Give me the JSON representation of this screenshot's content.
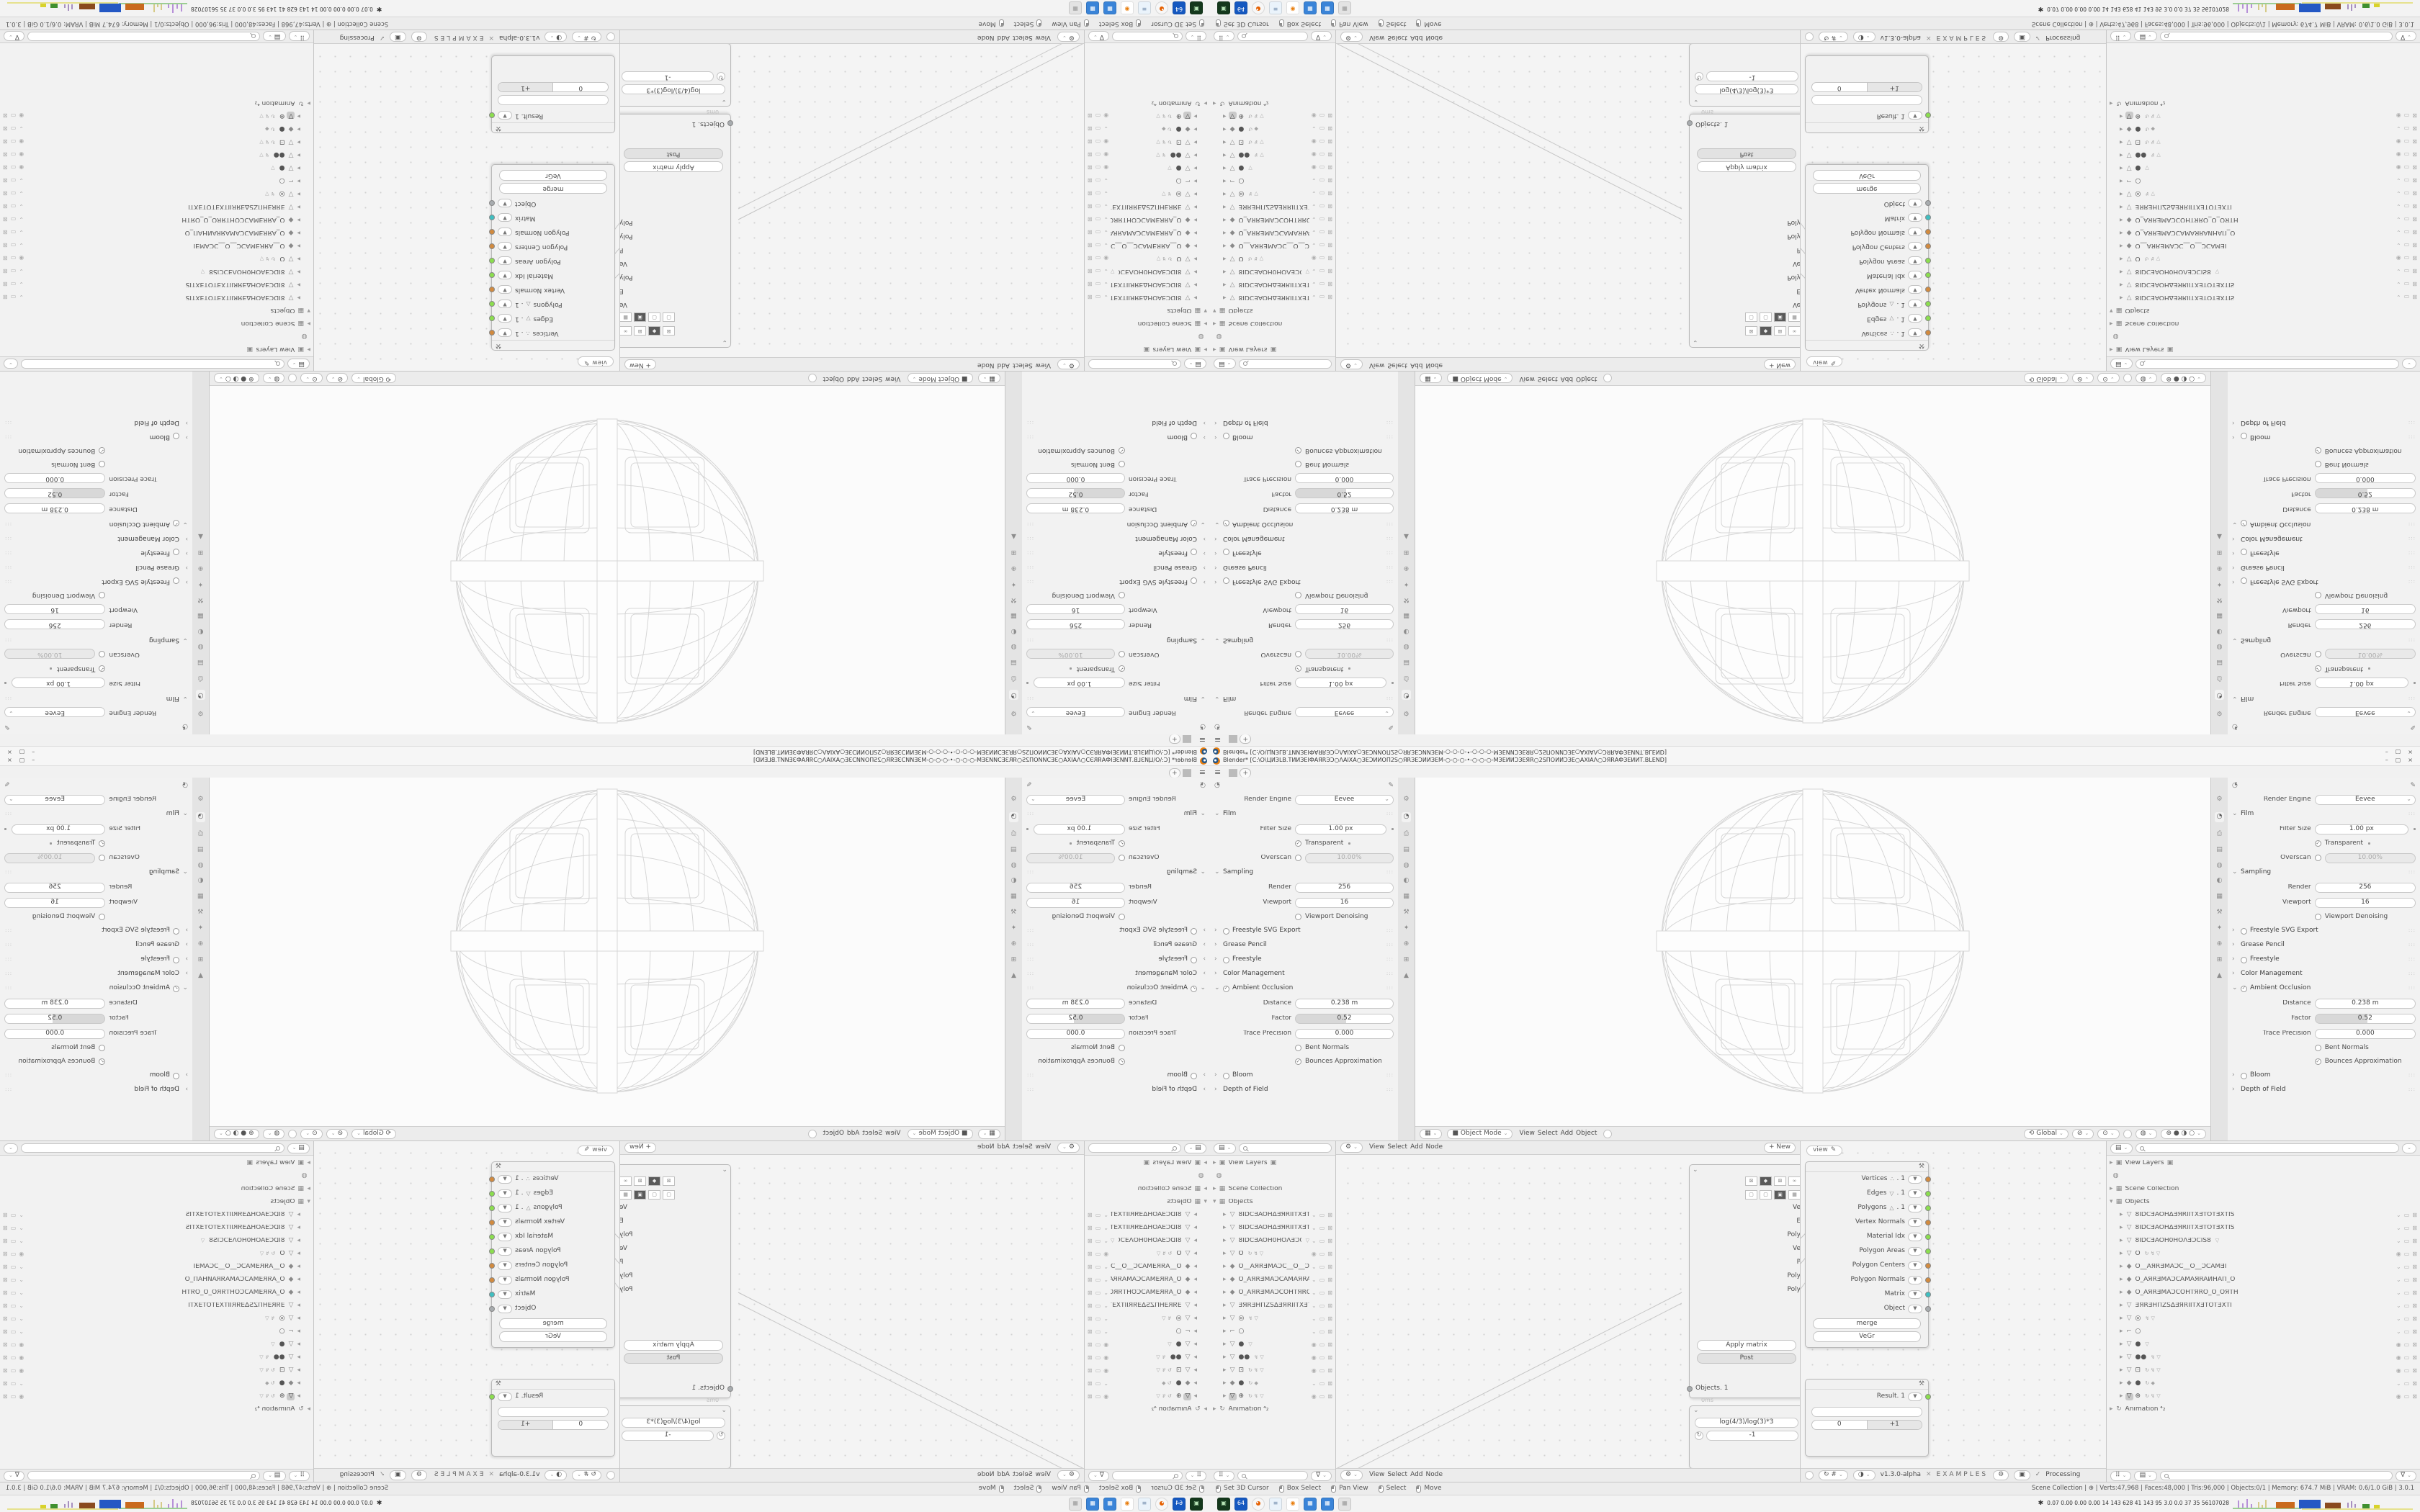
{
  "window": {
    "title": "Blender* [C:\\O\\ЦИЗLВ.ТИИЗЕІФАЯRЭƆ○ΛΑΙΧΑ○ЗЕƆИИОП2S○ЯRЗЕƆИИЗЕМ-○-○-○-•-○-○-○-МЗЕИИƆЗЕЯR○2SПОИИƆЗЕ○ΑΧΙΑΛ○ƆЯRАФЗЕИИТ.BLEND]",
    "controls": {
      "minimize": "–",
      "maximize": "▢",
      "close": "×"
    },
    "menu_icon": "≡"
  },
  "tabs": {
    "count": 6,
    "active": 2,
    "new_label": "+"
  },
  "colors": {
    "accent": "#E87D0D",
    "socket_orange": "#D28A3E",
    "socket_green": "#8BDE4E",
    "socket_teal": "#3FBFC1",
    "socket_gray": "#A8ACAF"
  },
  "props": {
    "rows": [
      {
        "t": "field",
        "label": "Render Engine",
        "value": "Eevee",
        "dd": true
      },
      {
        "t": "section",
        "label": "Film",
        "open": true,
        "tg": "none"
      },
      {
        "t": "field",
        "label": "Filter Size",
        "value": "1.00 px",
        "dot": true
      },
      {
        "t": "check",
        "label": "Transparent",
        "on": true,
        "dot": true
      },
      {
        "t": "fieldtoggle",
        "label": "Overscan",
        "value": "10.00%",
        "on": false
      },
      {
        "t": "section",
        "label": "Sampling",
        "open": true,
        "tg": "none"
      },
      {
        "t": "field",
        "label": "Render",
        "value": "256"
      },
      {
        "t": "field",
        "label": "Viewport",
        "value": "16"
      },
      {
        "t": "check",
        "label": "Viewport Denoising",
        "on": false
      },
      {
        "t": "section",
        "label": "Freestyle SVG Export",
        "open": false,
        "tg": "circle",
        "on": false
      },
      {
        "t": "section",
        "label": "Grease Pencil",
        "open": false,
        "tg": "none"
      },
      {
        "t": "section",
        "label": "Freestyle",
        "open": false,
        "tg": "circle",
        "on": false
      },
      {
        "t": "section",
        "label": "Color Management",
        "open": false,
        "tg": "none"
      },
      {
        "t": "section",
        "label": "Ambient Occlusion",
        "open": true,
        "tg": "circle",
        "on": true
      },
      {
        "t": "field",
        "label": "Distance",
        "value": "0.238 m"
      },
      {
        "t": "slider",
        "label": "Factor",
        "value": "0.52",
        "pct": 52
      },
      {
        "t": "field",
        "label": "Trace Precision",
        "value": "0.000"
      },
      {
        "t": "check",
        "label": "Bent Normals",
        "on": false
      },
      {
        "t": "check",
        "label": "Bounces Approximation",
        "on": true
      },
      {
        "t": "section",
        "label": "Bloom",
        "open": false,
        "tg": "circle",
        "on": false
      },
      {
        "t": "section",
        "label": "Depth of Field",
        "open": false,
        "tg": "none"
      }
    ],
    "tab_icons": [
      "tool",
      "render",
      "output",
      "viewlayer",
      "scene",
      "world",
      "object",
      "modifier",
      "particles",
      "physics",
      "constraints",
      "data"
    ]
  },
  "viewport": {
    "mode": "Object Mode",
    "menus": [
      "View",
      "Select",
      "Add",
      "Object"
    ],
    "orientation": "Global"
  },
  "node_editor_a": {
    "menus": [
      "View",
      "Select",
      "Add",
      "Node"
    ],
    "new_button": "+ New",
    "input_node": {
      "clipped_labels": [
        "Ve",
        "E",
        "Poly",
        "Ve",
        "P",
        "Poly",
        "Poly"
      ],
      "buttons": [
        "Apply matrix",
        "Post"
      ],
      "socket": "Objects. 1",
      "ms_note": "0ms"
    },
    "formula_node": {
      "formula": "log(4/3)/log(3)*3",
      "value": "-1"
    }
  },
  "node_editor_b": {
    "view_tab": "view",
    "geometry_node": {
      "sockets": [
        {
          "label": "Vertices",
          "ic": "∴",
          "suffix": ". 1",
          "c": "orange"
        },
        {
          "label": "Edges",
          "ic": "▽",
          "suffix": ". 1",
          "c": "green"
        },
        {
          "label": "Polygons",
          "ic": "△",
          "suffix": ". 1",
          "c": "green"
        },
        {
          "label": "Vertex Normals",
          "ic": "",
          "suffix": "",
          "c": "orange"
        },
        {
          "label": "Material Idx",
          "ic": "",
          "suffix": "",
          "c": "green"
        },
        {
          "label": "Polygon Areas",
          "ic": "",
          "suffix": "",
          "c": "green"
        },
        {
          "label": "Polygon Centers",
          "ic": "",
          "suffix": "",
          "c": "orange"
        },
        {
          "label": "Polygon Normals",
          "ic": "",
          "suffix": "",
          "c": "orange"
        },
        {
          "label": "Matrix",
          "ic": "",
          "suffix": "",
          "c": "teal"
        },
        {
          "label": "Object",
          "ic": "",
          "suffix": "",
          "c": "gray"
        }
      ],
      "buttons": [
        "merge",
        "VeGr"
      ]
    },
    "result_node": {
      "socket": "Result. 1",
      "c": "green",
      "value": "",
      "steps": [
        "0",
        "+1"
      ]
    },
    "footer": {
      "version": "v1.3.0-alpha",
      "tag": "EXAMPLES",
      "status": "Processing"
    }
  },
  "outliner": {
    "rows": [
      {
        "d": 0,
        "icon": "▣",
        "label": "View Layers",
        "chip": "▣",
        "r": "",
        "badges": ""
      },
      {
        "d": 0,
        "icon": "◍",
        "label": "",
        "r": "",
        "badges": ""
      },
      {
        "d": 0,
        "icon": "▦",
        "label": "Scene Collection",
        "r": "",
        "badges": ""
      },
      {
        "d": 0,
        "icon": "▦",
        "label": "Objects",
        "open": true,
        "r": "",
        "badges": ""
      },
      {
        "d": 1,
        "icon": "▽",
        "label": "8IDCƎAOHΔƎЯRIITXƎTOTƎXTIS",
        "r": "cmx",
        "badges": ""
      },
      {
        "d": 1,
        "icon": "▽",
        "label": "8IDCƎAOHΔƎЯRIITXƎTOTƎXTIS",
        "r": "cmx",
        "badges": ""
      },
      {
        "d": 1,
        "icon": "▽",
        "label": "8IDCƎAOH0HOΛƎƆCIS8",
        "r": "cmx",
        "badges": "▽"
      },
      {
        "d": 1,
        "icon": "▽",
        "label": "O",
        "r": "emx",
        "badges": "↻ ↯ ▽"
      },
      {
        "d": 1,
        "icon": "◆",
        "label": "O__AЯRƎMAƆC__O__ƆCAMƎI",
        "r": "cmx",
        "badges": ""
      },
      {
        "d": 1,
        "icon": "◆",
        "label": "O_AЯRƎMAƆCAMAЯRAИHAП_O",
        "r": "cmx",
        "badges": ""
      },
      {
        "d": 1,
        "icon": "◆",
        "label": "O_AЯRƎMAƆCOHTЯRO_O_OЯTH",
        "r": "cmx",
        "badges": ""
      },
      {
        "d": 1,
        "icon": "▽",
        "label": "ƎЯRƎHПZSΔƎЯRIITXƎTOTƎXTI",
        "r": "cmx",
        "badges": ""
      },
      {
        "d": 1,
        "icon": "▽",
        "label": "◎",
        "r": "cmx",
        "badges": "↯ ▽"
      },
      {
        "d": 1,
        "icon": "⌐",
        "label": "○",
        "r": "cmx",
        "badges": ""
      },
      {
        "d": 1,
        "icon": "▽",
        "label": "●",
        "r": "emx",
        "badges": "▽"
      },
      {
        "d": 1,
        "icon": "▽",
        "label": "●●",
        "r": "emx",
        "badges": "↯ ▽"
      },
      {
        "d": 1,
        "icon": "▽",
        "label": "⊡",
        "r": "emx",
        "badges": "↻ ↯ ▽"
      },
      {
        "d": 1,
        "icon": "◆",
        "label": "●",
        "r": "cmx",
        "badges": "↻ ◆"
      },
      {
        "d": 1,
        "icon": "▽",
        "label": "⊕",
        "r": "emx",
        "badges": "↻ ↯ ▽",
        "sel": true
      },
      {
        "d": 0,
        "icon": "↻",
        "label": "Animation",
        "suffix": "⁴₂",
        "r": "",
        "badges": ""
      }
    ]
  },
  "statusbar": {
    "hints": [
      "Set 3D Cursor",
      "Box Select",
      "Pan View",
      "Select",
      "Move"
    ],
    "stats": "Scene Collection  |  ⊕  |  Verts:47,968 | Faces:48,000 | Tris:96,000 | Objects:0/1 | Memory: 674.7 MiB | VRAM: 0.6/1.0 GiB | 3.0.1"
  },
  "taskbar": {
    "icons": [
      {
        "name": "capture-app-icon",
        "bg": "#14381c",
        "fg": "#b8e6b8",
        "glyph": "▣"
      },
      {
        "name": "floppy-64-icon",
        "bg": "#1558c0",
        "fg": "#ffffff",
        "glyph": "64"
      },
      {
        "name": "firefox-icon",
        "bg": "#f7f7f7",
        "fg": "#e66000",
        "glyph": "◕"
      },
      {
        "name": "notepad-icon",
        "bg": "#eaf3fb",
        "fg": "#6b87a8",
        "glyph": "≡"
      },
      {
        "name": "blender-icon",
        "bg": "#ffffff",
        "fg": "#e87d0d",
        "glyph": "◉"
      },
      {
        "name": "calculator-icon",
        "bg": "#3a84d8",
        "fg": "#ffffff",
        "glyph": "▦"
      },
      {
        "name": "calculator2-icon",
        "bg": "#3a84d8",
        "fg": "#ffffff",
        "glyph": "▦"
      },
      {
        "name": "inactive-app-icon",
        "bg": "#e3e3e3",
        "fg": "#9a9a9a",
        "glyph": "▦"
      }
    ],
    "tray": {
      "runner": "✱",
      "numbers": "0.07 0.00 0.00 0.00  14  143  628  41  143  95  3.0  0.0  37  35  56107028"
    }
  }
}
